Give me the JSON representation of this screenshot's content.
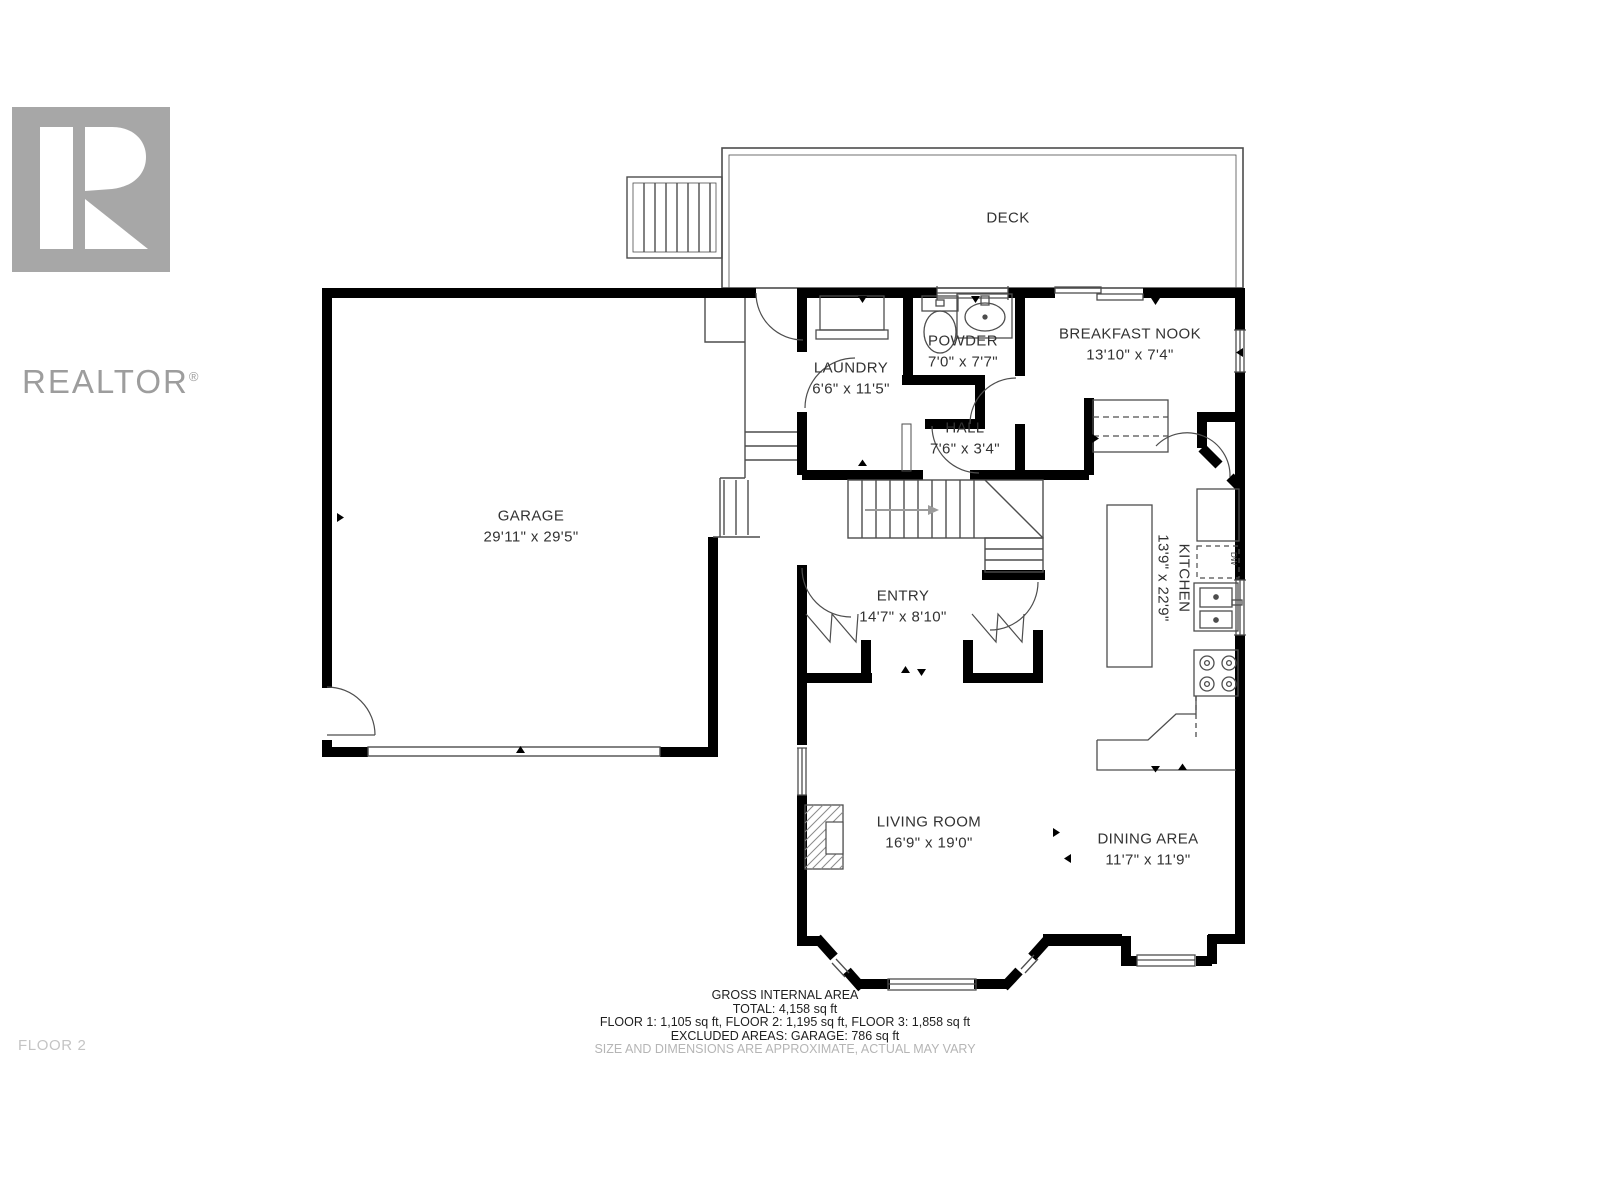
{
  "logo": {
    "brand": "REALTOR",
    "registered": "®"
  },
  "rooms": {
    "deck": {
      "name": "DECK",
      "dims": ""
    },
    "garage": {
      "name": "GARAGE",
      "dims": "29'11\" x 29'5\""
    },
    "laundry": {
      "name": "LAUNDRY",
      "dims": "6'6\" x 11'5\""
    },
    "powder": {
      "name": "POWDER",
      "dims": "7'0\" x 7'7\""
    },
    "hall": {
      "name": "HALL",
      "dims": "7'6\" x 3'4\""
    },
    "breakfast_nook": {
      "name": "BREAKFAST NOOK",
      "dims": "13'10\" x 7'4\""
    },
    "kitchen": {
      "name": "KITCHEN",
      "dims": "13'9\" x 22'9\""
    },
    "entry": {
      "name": "ENTRY",
      "dims": "14'7\" x 8'10\""
    },
    "living_room": {
      "name": "LIVING ROOM",
      "dims": "16'9\" x 19'0\""
    },
    "dining_area": {
      "name": "DINING AREA",
      "dims": "11'7\" x 11'9\""
    }
  },
  "fixtures": {
    "dishwasher": "DW"
  },
  "footer": {
    "title": "GROSS INTERNAL AREA",
    "total": "TOTAL: 4,158 sq ft",
    "floors": "FLOOR 1: 1,105 sq ft, FLOOR 2: 1,195 sq ft, FLOOR 3: 1,858 sq ft",
    "excluded": "EXCLUDED AREAS: GARAGE: 786 sq ft",
    "disclaimer": "SIZE AND DIMENSIONS ARE APPROXIMATE, ACTUAL MAY VARY"
  },
  "floor_label": "FLOOR 2",
  "colors": {
    "wall": "#000000",
    "thin_line": "#4d4d4d",
    "label": "#323232",
    "muted": "#b5b5b5",
    "logo_gray": "#a7a7a7"
  }
}
